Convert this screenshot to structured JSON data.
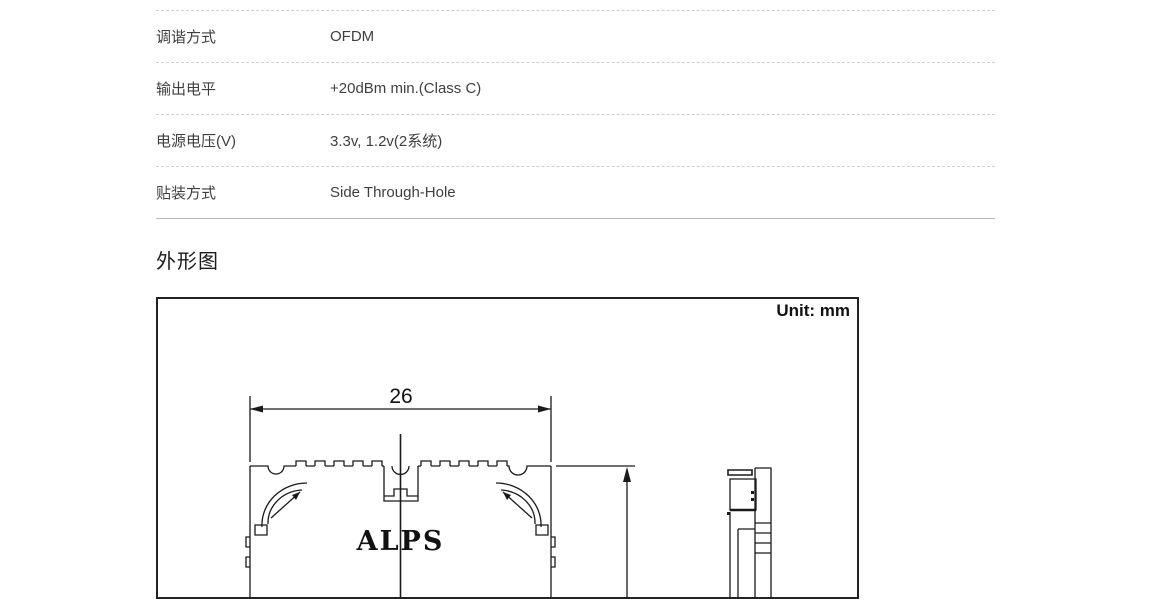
{
  "spec_table": {
    "rows": [
      {
        "label": "调谐方式",
        "value": "OFDM"
      },
      {
        "label": "输出电平",
        "value": "+20dBm min.(Class C)"
      },
      {
        "label": "电源电压(V)",
        "value": "3.3v, 1.2v(2系统)"
      },
      {
        "label": "贴装方式",
        "value": "Side Through-Hole"
      }
    ],
    "divider_color": "#cfcfcf",
    "bottom_border_color": "#b9b9b9",
    "text_color": "#3f3f3f"
  },
  "section": {
    "heading": "外形图"
  },
  "drawing": {
    "unit_label": "Unit: mm",
    "width_dimension": "26",
    "logo_text": "ALPS",
    "line_color": "#1a1a1a",
    "background": "#ffffff"
  }
}
